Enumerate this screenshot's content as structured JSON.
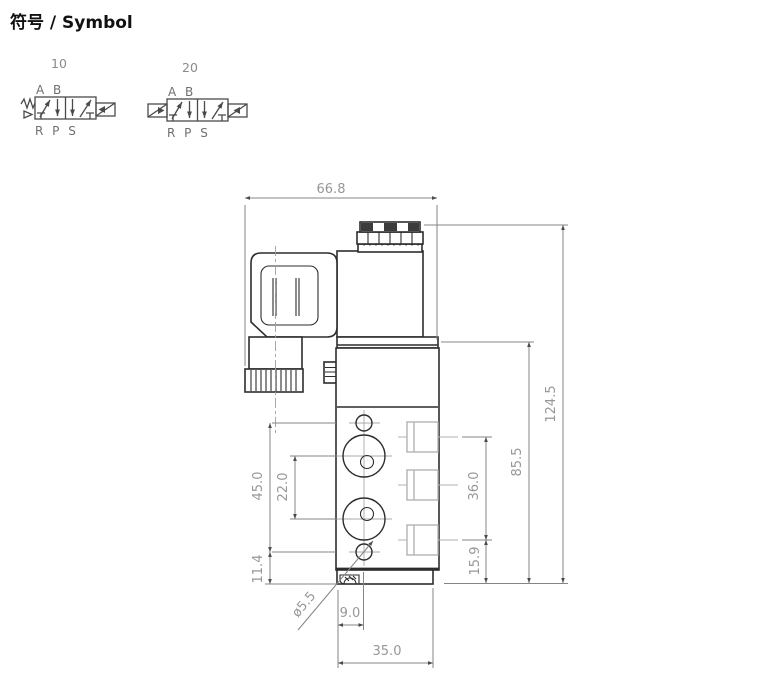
{
  "header": {
    "title": "符号 / Symbol"
  },
  "symbols": {
    "valve_10": {
      "label": "10",
      "ports_top": "A B",
      "ports_bottom": "R P S"
    },
    "valve_20": {
      "label": "20",
      "ports_top": "A B",
      "ports_bottom": "R P S"
    }
  },
  "drawing": {
    "dims": {
      "overall_width": "66.8",
      "overall_height": "124.5",
      "body_height": "85.5",
      "port_span": "36.0",
      "port_offset_bottom": "15.9",
      "hole_span": "45.0",
      "outlet_span": "22.0",
      "hole_offset_bottom": "11.4",
      "mount_hole_dia": "ø5.5",
      "hole_offset_side": "9.0",
      "base_width": "35.0"
    },
    "colors": {
      "line": "#2d2d2d",
      "dimension": "#858585",
      "dimension_text": "#979797",
      "port_hidden": "#b3b3b3"
    }
  }
}
